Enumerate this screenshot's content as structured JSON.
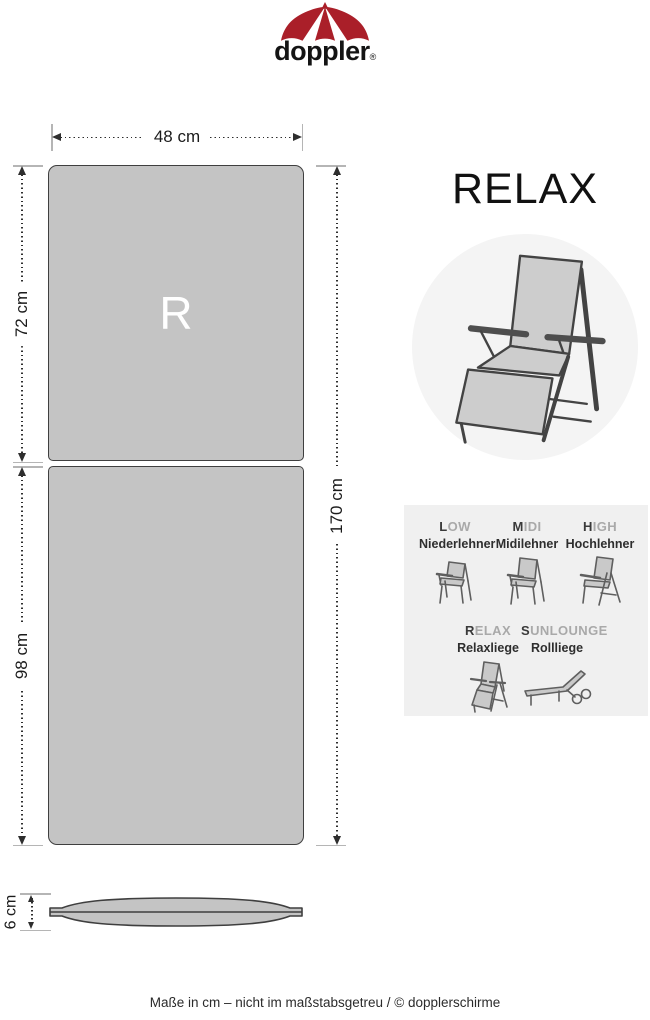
{
  "colors": {
    "brand_red": "#aa1f29",
    "cushion_fill": "#c4c4c4",
    "cushion_outline": "#3f3f3f",
    "dim_line": "#2e2e2e",
    "ext_line": "#b5b5b5",
    "circle_bg": "#f4f4f4",
    "panel_bg": "#f0f0f0",
    "muted_text": "#a9a9a9",
    "dark_text": "#3a3a3a"
  },
  "logo": {
    "brand": "doppler",
    "registered": "®"
  },
  "title": "RELAX",
  "cushion": {
    "marking": "R"
  },
  "dimensions": {
    "width": "48 cm",
    "back_length": "72 cm",
    "seat_length": "98 cm",
    "total_length": "170 cm",
    "thickness": "6 cm"
  },
  "panel": {
    "types": [
      {
        "initial": "L",
        "rest": "OW",
        "name": "Niederlehner"
      },
      {
        "initial": "M",
        "rest": "IDI",
        "name": "Midilehner"
      },
      {
        "initial": "H",
        "rest": "IGH",
        "name": "Hochlehner"
      },
      {
        "initial": "R",
        "rest": "ELAX",
        "name": "Relaxliege"
      },
      {
        "initial": "S",
        "rest": "UNLOUNGE",
        "name": "Rollliege"
      }
    ]
  },
  "footer": "Maße in cm – nicht im maßstabsgetreu / © dopplerschirme"
}
